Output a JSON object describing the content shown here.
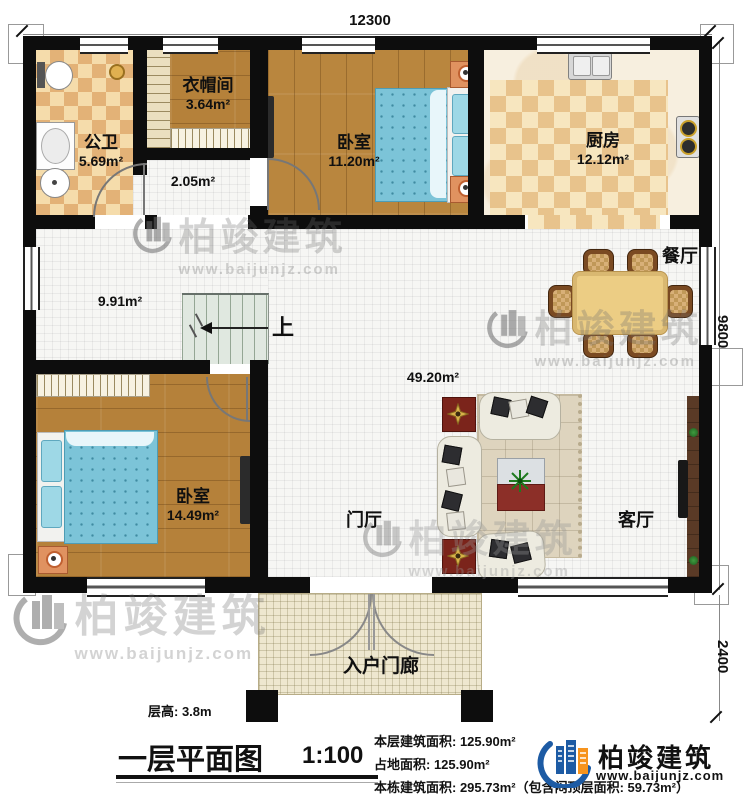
{
  "dimensions": {
    "width_mm": "12300",
    "depth_mm": "9800",
    "porch_depth_mm": "2400"
  },
  "rooms": {
    "bathroom": {
      "name": "公卫",
      "area": "5.69m²"
    },
    "cloakroom": {
      "name": "衣帽间",
      "area": "3.64m²"
    },
    "hall": {
      "area": "2.05m²"
    },
    "bedroom1": {
      "name": "卧室",
      "area": "11.20m²"
    },
    "kitchen": {
      "name": "厨房",
      "area": "12.12m²"
    },
    "corridor": {
      "area": "9.91m²"
    },
    "dining": {
      "name": "餐厅"
    },
    "open_area": {
      "area": "49.20m²"
    },
    "bedroom2": {
      "name": "卧室",
      "area": "14.49m²"
    },
    "foyer": {
      "name": "门厅"
    },
    "living": {
      "name": "客厅"
    },
    "porch": {
      "name": "入户门廊"
    }
  },
  "stairs": {
    "direction_label": "上"
  },
  "footer": {
    "floor_height": "层高: 3.8m",
    "title": "一层平面图",
    "scale": "1:100",
    "stats": {
      "line1": "本层建筑面积: 125.90m²",
      "line2": "占地面积: 125.90m²",
      "line3": "本栋建筑面积: 295.73m²（包含闷顶层面积: 59.73m²）"
    }
  },
  "branding": {
    "company": "柏竣建筑",
    "website": "www.baijunjz.com"
  },
  "colors": {
    "wall": "#0d0d0d",
    "wood_floor": "#b9863e",
    "tile_checker_light": "#f5dcab",
    "tile_checker_dark": "#e3b277",
    "stair": "#e0e8e0",
    "brand_blue": "#1d5ba4",
    "brand_orange": "#f7941d",
    "mattress_blue": "#7cc4d8",
    "dining_table": "#eccd84",
    "sofa": "#edebe0",
    "rug": "#ded4be",
    "accent_table_red": "#7b241b",
    "porch_tile": "#efe8d0"
  }
}
